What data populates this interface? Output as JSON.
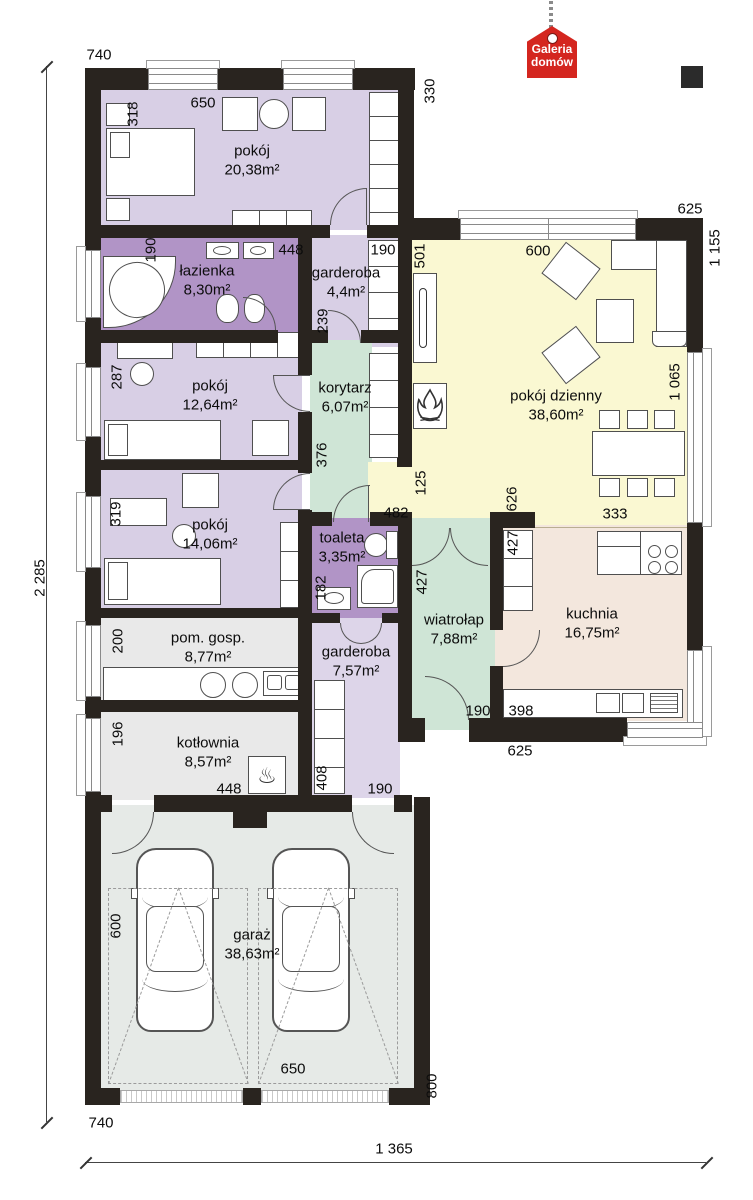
{
  "brand": {
    "line1": "Galeria",
    "line2": "domów"
  },
  "rooms": {
    "pokoj1": {
      "name": "pokój",
      "area": "20,38m²"
    },
    "lazienka": {
      "name": "łazienka",
      "area": "8,30m²"
    },
    "garderoba1": {
      "name": "garderoba",
      "area": "4,4m²"
    },
    "pokoj2": {
      "name": "pokój",
      "area": "12,64m²"
    },
    "korytarz": {
      "name": "korytarz",
      "area": "6,07m²"
    },
    "pokoj_dzienny": {
      "name": "pokój dzienny",
      "area": "38,60m²"
    },
    "pokoj3": {
      "name": "pokój",
      "area": "14,06m²"
    },
    "toaleta": {
      "name": "toaleta",
      "area": "3,35m²"
    },
    "wiatrolap": {
      "name": "wiatrołap",
      "area": "7,88m²"
    },
    "kuchnia": {
      "name": "kuchnia",
      "area": "16,75m²"
    },
    "pom_gosp": {
      "name": "pom. gosp.",
      "area": "8,77m²"
    },
    "garderoba2": {
      "name": "garderoba",
      "area": "7,57m²"
    },
    "kotlownia": {
      "name": "kotłownia",
      "area": "8,57m²"
    },
    "garaz": {
      "name": "garaż",
      "area": "38,63m²"
    }
  },
  "dims": {
    "t740": "740",
    "v330": "330",
    "t625": "625",
    "v1155": "1 155",
    "v318": "318",
    "h650": "650",
    "v190a": "190",
    "h448a": "448",
    "h190b": "190",
    "v239": "239",
    "v501": "501",
    "h600": "600",
    "v287": "287",
    "v376": "376",
    "v1065": "1 065",
    "v125": "125",
    "h482": "482",
    "v626": "626",
    "h333": "333",
    "v319": "319",
    "v182": "182",
    "v427a": "427",
    "v427b": "427",
    "v200": "200",
    "h398": "398",
    "v196": "196",
    "h448b": "448",
    "v408": "408",
    "h190c": "190",
    "h190d": "190",
    "h625": "625",
    "v600": "600",
    "h650b": "650",
    "v800": "800",
    "b740": "740",
    "h1365": "1 365",
    "v2285": "2 285"
  },
  "colors": {
    "wall": "#29241f",
    "room_purple": "#d8cfe5",
    "room_purple_dark": "#b194c6",
    "room_green": "#cfe5d6",
    "room_yellow": "#faf8d2",
    "room_beige": "#f3e7dd",
    "room_gray": "#e9e9e9",
    "room_garage": "#e6eae7",
    "logo_red": "#d4261f"
  }
}
